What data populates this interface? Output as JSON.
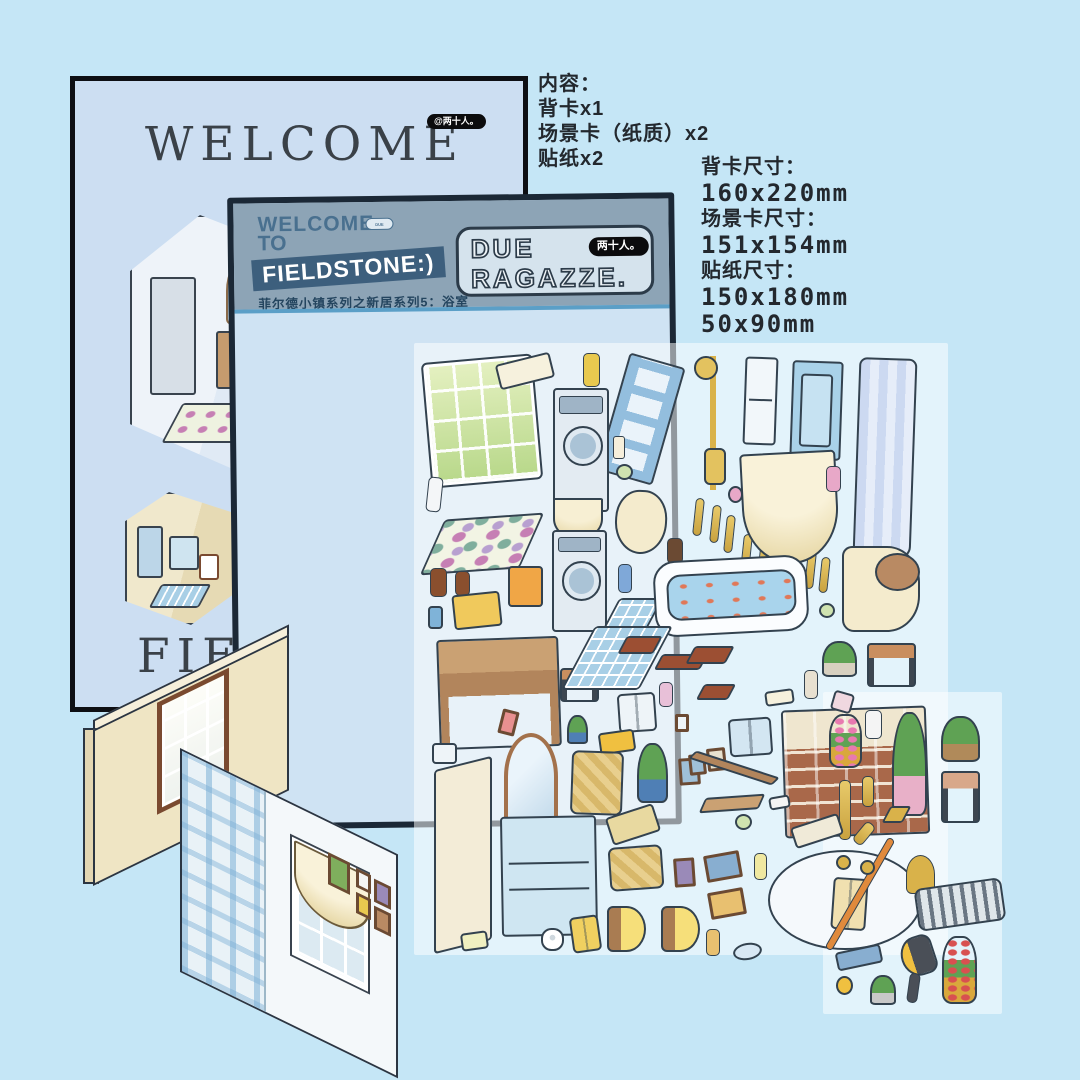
{
  "canvas": {
    "bg": "#c5e6f6"
  },
  "back_card": {
    "brand_badge": "@两十人。",
    "title": "WELCOME",
    "partial_bottom_text": "FIELD"
  },
  "main_card": {
    "welcome": "WELCOME",
    "to": "TO",
    "banner": "FIELDSTONE:)",
    "mini_badge": "DUE RAGAZZE",
    "subtitle": "菲尔德小镇系列之新居系列5：浴室",
    "badge": {
      "line1": "DUE",
      "line2": "RAGAZZE.",
      "brand": "两十人。"
    },
    "colors": {
      "border": "#1b2836",
      "header": "#8da4b6",
      "banner": "#3d5f7d",
      "body": "#cfe3f3"
    }
  },
  "notes": {
    "contents_title": "内容：",
    "contents": [
      "背卡x1",
      "场景卡（纸质）x2",
      "贴纸x2"
    ],
    "sizes": [
      {
        "label": "背卡尺寸：",
        "values": [
          "160x220mm"
        ]
      },
      {
        "label": "场景卡尺寸：",
        "values": [
          "151x154mm"
        ]
      },
      {
        "label": "贴纸尺寸：",
        "values": [
          "150x180mm",
          "50x90mm"
        ]
      }
    ]
  },
  "stickers": [
    {
      "n": "window-sticker",
      "k": "window",
      "x": 428,
      "y": 360,
      "w": 108,
      "h": 122,
      "r": -5
    },
    {
      "n": "soap-tray-sticker",
      "k": "box",
      "x": 497,
      "y": 358,
      "w": 56,
      "h": 26,
      "r": -14,
      "c": "#f6f1dd"
    },
    {
      "n": "soap-dispenser",
      "k": "bottle",
      "x": 583,
      "y": 353,
      "w": 17,
      "h": 34,
      "c": "#e8c94f"
    },
    {
      "n": "ladder",
      "k": "ladder",
      "x": 612,
      "y": 358,
      "w": 58,
      "h": 122,
      "r": 16
    },
    {
      "n": "shower-set",
      "k": "shower",
      "x": 694,
      "y": 356,
      "w": 38,
      "h": 134
    },
    {
      "n": "wall-niche",
      "k": "niche",
      "x": 744,
      "y": 357,
      "w": 33,
      "h": 88,
      "r": 2
    },
    {
      "n": "shower-cabin",
      "k": "cabin",
      "x": 791,
      "y": 361,
      "w": 51,
      "h": 99,
      "r": 2
    },
    {
      "n": "shower-curtain",
      "k": "curtain",
      "x": 856,
      "y": 358,
      "w": 58,
      "h": 200,
      "r": 2
    },
    {
      "n": "washing-machine-1",
      "k": "washer",
      "x": 553,
      "y": 388,
      "w": 56,
      "h": 124
    },
    {
      "n": "candle",
      "k": "candle",
      "x": 613,
      "y": 436,
      "w": 12,
      "h": 23
    },
    {
      "n": "candle-jar",
      "k": "round",
      "x": 616,
      "y": 464,
      "w": 17,
      "h": 16,
      "c": "#cfe3b0"
    },
    {
      "n": "toothpaste",
      "k": "bottle",
      "x": 427,
      "y": 477,
      "w": 15,
      "h": 35,
      "r": 6,
      "c": "#f4f6f8"
    },
    {
      "n": "dotted-rug",
      "k": "rug",
      "x": 432,
      "y": 517,
      "w": 100,
      "h": 54,
      "r": -4
    },
    {
      "n": "amber-bottle-1",
      "k": "bottle",
      "x": 430,
      "y": 568,
      "w": 17,
      "h": 29,
      "c": "#8a4f2e"
    },
    {
      "n": "amber-bottle-2",
      "k": "bottle",
      "x": 455,
      "y": 571,
      "w": 15,
      "h": 25,
      "c": "#8a4f2e"
    },
    {
      "n": "toothbrush-cup",
      "k": "box",
      "x": 428,
      "y": 606,
      "w": 15,
      "h": 23,
      "c": "#7fb3d8"
    },
    {
      "n": "baby-tub",
      "k": "box",
      "x": 453,
      "y": 593,
      "w": 48,
      "h": 35,
      "r": -6,
      "c": "#f0c95c"
    },
    {
      "n": "waste-bin",
      "k": "box",
      "x": 508,
      "y": 566,
      "w": 35,
      "h": 41,
      "c": "#f0a646"
    },
    {
      "n": "scallop-valance",
      "k": "swag",
      "x": 553,
      "y": 498,
      "w": 50,
      "h": 42,
      "c": "#f7efd3"
    },
    {
      "n": "washing-machine-2",
      "k": "washer",
      "x": 552,
      "y": 530,
      "w": 55,
      "h": 102
    },
    {
      "n": "bidet",
      "k": "basin",
      "x": 615,
      "y": 490,
      "w": 52,
      "h": 64,
      "r": 3
    },
    {
      "n": "perfume-amber",
      "k": "bottle",
      "x": 667,
      "y": 538,
      "w": 16,
      "h": 26,
      "c": "#6b4a33"
    },
    {
      "n": "blue-bottle",
      "k": "bottle",
      "x": 618,
      "y": 564,
      "w": 14,
      "h": 29,
      "c": "#7fa8d8"
    },
    {
      "n": "tile-mat-small",
      "k": "tile",
      "x": 604,
      "y": 598,
      "w": 44,
      "h": 58
    },
    {
      "n": "baluster-1",
      "k": "baluster",
      "x": 694,
      "y": 498,
      "w": 9,
      "h": 38,
      "r": 6
    },
    {
      "n": "baluster-2",
      "k": "baluster",
      "x": 711,
      "y": 505,
      "w": 9,
      "h": 38,
      "r": 6
    },
    {
      "n": "baluster-3",
      "k": "baluster",
      "x": 725,
      "y": 515,
      "w": 9,
      "h": 38,
      "r": 6
    },
    {
      "n": "baluster-4",
      "k": "baluster",
      "x": 742,
      "y": 534,
      "w": 9,
      "h": 38,
      "r": 6
    },
    {
      "n": "baluster-5",
      "k": "baluster",
      "x": 759,
      "y": 539,
      "w": 9,
      "h": 38,
      "r": 6
    },
    {
      "n": "baluster-6",
      "k": "baluster",
      "x": 806,
      "y": 551,
      "w": 9,
      "h": 38,
      "r": 6
    },
    {
      "n": "baluster-7",
      "k": "baluster",
      "x": 820,
      "y": 557,
      "w": 9,
      "h": 36,
      "r": 6
    },
    {
      "n": "curtain-swag",
      "k": "swag",
      "x": 742,
      "y": 452,
      "w": 96,
      "h": 112,
      "r": -3,
      "c": "#f9f2d9"
    },
    {
      "n": "bud-vase-pink",
      "k": "bottle",
      "x": 826,
      "y": 466,
      "w": 15,
      "h": 26,
      "c": "#e8a8c8"
    },
    {
      "n": "pink-soap",
      "k": "round",
      "x": 728,
      "y": 486,
      "w": 15,
      "h": 17,
      "c": "#e8a8c8"
    },
    {
      "n": "bathtub",
      "k": "tub",
      "x": 654,
      "y": 558,
      "w": 154,
      "h": 76,
      "r": -3
    },
    {
      "n": "toilet",
      "k": "toilet",
      "x": 842,
      "y": 546,
      "w": 78,
      "h": 86
    },
    {
      "n": "green-soap",
      "k": "round",
      "x": 819,
      "y": 603,
      "w": 16,
      "h": 15,
      "c": "#cfe3b0"
    },
    {
      "n": "vanity-desk",
      "k": "desk",
      "x": 438,
      "y": 638,
      "w": 122,
      "h": 110,
      "r": -2
    },
    {
      "n": "step-stool",
      "k": "stool",
      "x": 560,
      "y": 668,
      "w": 39,
      "h": 34,
      "c": "#c98e5f"
    },
    {
      "n": "tile-mat-large",
      "k": "tile",
      "x": 578,
      "y": 626,
      "w": 78,
      "h": 64
    },
    {
      "n": "wood-mat-1",
      "k": "plank",
      "x": 622,
      "y": 636,
      "w": 36,
      "h": 18
    },
    {
      "n": "wood-mat-2",
      "k": "plank",
      "x": 658,
      "y": 654,
      "w": 46,
      "h": 16
    },
    {
      "n": "wood-mat-3",
      "k": "plank",
      "x": 690,
      "y": 646,
      "w": 40,
      "h": 18
    },
    {
      "n": "wood-mat-4",
      "k": "plank",
      "x": 700,
      "y": 684,
      "w": 32,
      "h": 16
    },
    {
      "n": "towel-print",
      "k": "towel",
      "x": 618,
      "y": 693,
      "w": 38,
      "h": 39,
      "r": -4,
      "c": "#eef4f8"
    },
    {
      "n": "photo-frame-pink",
      "k": "frame",
      "x": 500,
      "y": 710,
      "w": 17,
      "h": 25,
      "r": 14,
      "c": "#e89090"
    },
    {
      "n": "succulent",
      "k": "plant",
      "x": 567,
      "y": 715,
      "w": 21,
      "h": 29,
      "p": "#4f7fb5"
    },
    {
      "n": "perfume-pink",
      "k": "bottle",
      "x": 659,
      "y": 682,
      "w": 14,
      "h": 25,
      "c": "#e8c0d8"
    },
    {
      "n": "yellow-mat",
      "k": "box",
      "x": 599,
      "y": 731,
      "w": 36,
      "h": 22,
      "r": -8,
      "c": "#f0c040"
    },
    {
      "n": "aloe-plant",
      "k": "plant",
      "x": 637,
      "y": 743,
      "w": 31,
      "h": 60,
      "p": "#4f7fb5"
    },
    {
      "n": "arch-mirror",
      "k": "mirror",
      "x": 504,
      "y": 733,
      "w": 54,
      "h": 104
    },
    {
      "n": "soap-dish",
      "k": "box",
      "x": 432,
      "y": 743,
      "w": 25,
      "h": 21,
      "c": "#eef4f8"
    },
    {
      "n": "shower-door-panel",
      "k": "tall",
      "x": 434,
      "y": 763,
      "w": 58,
      "h": 184,
      "c": "#f3ecd7"
    },
    {
      "n": "basket-bag",
      "k": "basket",
      "x": 571,
      "y": 751,
      "w": 52,
      "h": 64,
      "r": 2
    },
    {
      "n": "wall-outlet",
      "k": "frame",
      "x": 675,
      "y": 714,
      "w": 14,
      "h": 18,
      "c": "#eef4f8"
    },
    {
      "n": "frame-blue",
      "k": "frame",
      "x": 679,
      "y": 758,
      "w": 21,
      "h": 27,
      "r": -4,
      "c": "#9fc0d8"
    },
    {
      "n": "aroma-diffuser",
      "k": "bottle",
      "x": 804,
      "y": 670,
      "w": 14,
      "h": 29,
      "c": "#e8e0d0"
    },
    {
      "n": "potted-plant",
      "k": "plant",
      "x": 822,
      "y": 641,
      "w": 35,
      "h": 36,
      "p": "#d8d0c0"
    },
    {
      "n": "dark-stool",
      "k": "stool",
      "x": 867,
      "y": 643,
      "w": 49,
      "h": 44,
      "c": "#c98e5f"
    },
    {
      "n": "rolled-towel",
      "k": "box",
      "x": 765,
      "y": 690,
      "w": 29,
      "h": 15,
      "r": -8,
      "c": "#f6f1dd"
    },
    {
      "n": "brick-counter",
      "k": "brick",
      "x": 783,
      "y": 708,
      "w": 145,
      "h": 128,
      "r": -2
    },
    {
      "n": "tulip-vase",
      "k": "rose",
      "x": 829,
      "y": 714,
      "w": 33,
      "h": 54,
      "f": "#e87ab0"
    },
    {
      "n": "white-vase",
      "k": "bottle",
      "x": 865,
      "y": 710,
      "w": 17,
      "h": 29,
      "c": "#f4f4f4"
    },
    {
      "n": "hanging-plant",
      "k": "plant",
      "x": 892,
      "y": 712,
      "w": 35,
      "h": 104,
      "p": "#e8b0c8"
    },
    {
      "n": "monstera-basket",
      "k": "plant",
      "x": 941,
      "y": 716,
      "w": 39,
      "h": 46,
      "p": "#b08a5a"
    },
    {
      "n": "tissue-papers",
      "k": "box",
      "x": 832,
      "y": 692,
      "w": 21,
      "h": 20,
      "r": 16,
      "c": "#f0d8e0"
    },
    {
      "n": "hand-towel-blue",
      "k": "towel",
      "x": 729,
      "y": 718,
      "w": 43,
      "h": 38,
      "r": -4,
      "c": "#d3e6f2"
    },
    {
      "n": "frame-small-a",
      "k": "frame",
      "x": 689,
      "y": 754,
      "w": 17,
      "h": 21,
      "r": -6,
      "c": "#9fc0d8"
    },
    {
      "n": "frame-small-b",
      "k": "frame",
      "x": 707,
      "y": 748,
      "w": 19,
      "h": 23,
      "r": -6,
      "c": "#e8e2cf"
    },
    {
      "n": "towel-rail",
      "k": "plank",
      "x": 690,
      "y": 763,
      "w": 88,
      "h": 10,
      "r": 18,
      "c": "#b2855c"
    },
    {
      "n": "wood-bench",
      "k": "plank",
      "x": 702,
      "y": 796,
      "w": 60,
      "h": 15,
      "r": -4,
      "c": "#caa173"
    },
    {
      "n": "green-jar",
      "k": "round",
      "x": 735,
      "y": 814,
      "w": 17,
      "h": 16,
      "c": "#cfe3b0"
    },
    {
      "n": "soap-tray-small",
      "k": "box",
      "x": 769,
      "y": 796,
      "w": 21,
      "h": 13,
      "r": -10,
      "c": "#f4f4f4"
    },
    {
      "n": "round-stool",
      "k": "stool",
      "x": 941,
      "y": 771,
      "w": 39,
      "h": 52,
      "c": "#d8a88a"
    },
    {
      "n": "candlestick-1",
      "k": "baluster",
      "x": 839,
      "y": 780,
      "w": 12,
      "h": 60
    },
    {
      "n": "candlestick-2",
      "k": "baluster",
      "x": 862,
      "y": 776,
      "w": 12,
      "h": 31
    },
    {
      "n": "candlestick-3",
      "k": "baluster",
      "x": 858,
      "y": 821,
      "w": 12,
      "h": 25,
      "r": 40
    },
    {
      "n": "gold-tray",
      "k": "plank",
      "x": 886,
      "y": 806,
      "w": 21,
      "h": 17,
      "c": "#d9b24a"
    },
    {
      "n": "brush-tray",
      "k": "box",
      "x": 792,
      "y": 820,
      "w": 50,
      "h": 22,
      "r": -18,
      "c": "#f0ead8"
    },
    {
      "n": "storage-cabinet",
      "k": "cabinet",
      "x": 501,
      "y": 816,
      "w": 96,
      "h": 120,
      "r": -1
    },
    {
      "n": "mop-board",
      "k": "box",
      "x": 608,
      "y": 810,
      "w": 50,
      "h": 29,
      "r": -18,
      "c": "#e8d9a0"
    },
    {
      "n": "slipper-basket",
      "k": "basket",
      "x": 609,
      "y": 846,
      "w": 54,
      "h": 44,
      "r": -4
    },
    {
      "n": "frame-purple",
      "k": "frame",
      "x": 674,
      "y": 858,
      "w": 21,
      "h": 29,
      "r": -4,
      "c": "#9a8ab8"
    },
    {
      "n": "mosaic-frame-1",
      "k": "frame",
      "x": 705,
      "y": 853,
      "w": 36,
      "h": 27,
      "r": -10,
      "c": "#88aed0"
    },
    {
      "n": "mosaic-frame-2",
      "k": "frame",
      "x": 709,
      "y": 890,
      "w": 36,
      "h": 27,
      "r": -10,
      "c": "#e8c070"
    },
    {
      "n": "lotion-tube",
      "k": "bottle",
      "x": 754,
      "y": 853,
      "w": 13,
      "h": 27,
      "c": "#f0e8a0"
    },
    {
      "n": "toilet-paper",
      "k": "paper",
      "x": 541,
      "y": 928,
      "w": 23,
      "h": 23
    },
    {
      "n": "yellow-towel",
      "k": "towel",
      "x": 571,
      "y": 916,
      "w": 29,
      "h": 36,
      "r": -8,
      "c": "#f0d060"
    },
    {
      "n": "wall-sconce-1",
      "k": "sconce",
      "x": 607,
      "y": 906,
      "w": 39,
      "h": 46
    },
    {
      "n": "wall-sconce-2",
      "k": "sconce",
      "x": 661,
      "y": 906,
      "w": 39,
      "h": 46
    },
    {
      "n": "tissue-pack",
      "k": "box",
      "x": 461,
      "y": 932,
      "w": 27,
      "h": 18,
      "r": -8,
      "c": "#f0f0c0"
    },
    {
      "n": "round-rug",
      "k": "round",
      "x": 768,
      "y": 850,
      "w": 154,
      "h": 100,
      "c": "#f5f9fc"
    },
    {
      "n": "bath-towel",
      "k": "towel",
      "x": 832,
      "y": 878,
      "w": 35,
      "h": 52,
      "r": 4,
      "c": "#f0e0b0"
    },
    {
      "n": "mop-handle",
      "k": "bottle",
      "x": 856,
      "y": 830,
      "w": 8,
      "h": 128,
      "r": 30,
      "c": "#e08a3c"
    },
    {
      "n": "mop-pad",
      "k": "box",
      "x": 836,
      "y": 948,
      "w": 46,
      "h": 19,
      "r": -12,
      "c": "#88aed0"
    },
    {
      "n": "gold-hook-1",
      "k": "round",
      "x": 836,
      "y": 855,
      "w": 15,
      "h": 15,
      "c": "#d9b24a"
    },
    {
      "n": "gold-hook-2",
      "k": "round",
      "x": 860,
      "y": 860,
      "w": 15,
      "h": 15,
      "c": "#d9b24a"
    },
    {
      "n": "gold-faucet",
      "k": "faucet",
      "x": 906,
      "y": 855,
      "w": 29,
      "h": 39
    },
    {
      "n": "towel-rack",
      "k": "rack",
      "x": 916,
      "y": 883,
      "w": 88,
      "h": 43,
      "r": -8
    },
    {
      "n": "lotion-bottle",
      "k": "bottle",
      "x": 706,
      "y": 929,
      "w": 14,
      "h": 27,
      "c": "#e8c070"
    },
    {
      "n": "eye-mask",
      "k": "round",
      "x": 733,
      "y": 943,
      "w": 29,
      "h": 17,
      "r": -10,
      "c": "#d8e8f4"
    },
    {
      "n": "hair-dryer",
      "k": "dryer",
      "x": 901,
      "y": 936,
      "w": 34,
      "h": 40,
      "r": -18
    },
    {
      "n": "rose-vase",
      "k": "rose",
      "x": 942,
      "y": 936,
      "w": 35,
      "h": 68,
      "f": "#d85050"
    },
    {
      "n": "mini-plant",
      "k": "plant",
      "x": 870,
      "y": 975,
      "w": 26,
      "h": 30,
      "p": "#c8c8c8"
    },
    {
      "n": "duck-hook",
      "k": "round",
      "x": 836,
      "y": 976,
      "w": 17,
      "h": 19,
      "c": "#f0c040"
    },
    {
      "n": "grooming-tool",
      "k": "bottle",
      "x": 908,
      "y": 973,
      "w": 11,
      "h": 30,
      "r": 8,
      "c": "#4a4f57"
    }
  ]
}
